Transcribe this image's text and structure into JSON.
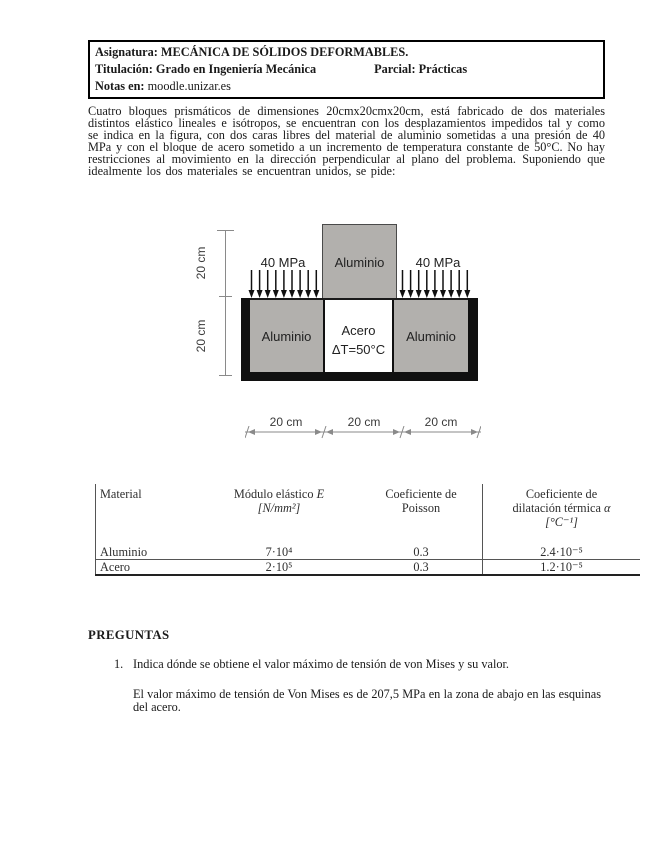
{
  "header_box": {
    "asignatura_label": "Asignatura:",
    "asignatura_value": " MECÁNICA DE SÓLIDOS DEFORMABLES.",
    "titulacion_label": "Titulación:",
    "titulacion_value": " Grado en Ingeniería Mecánica",
    "parcial_label": "Parcial:",
    "parcial_value": " Prácticas",
    "notas_label": "Notas en:",
    "notas_value": " moodle.unizar.es"
  },
  "problem_text": "Cuatro bloques prismáticos de dimensiones 20cmx20cmx20cm, está fabricado de dos materiales distintos elástico lineales e isótropos, se encuentran con los desplazamientos impedidos tal y como se indica en la figura, con dos caras libres del material de aluminio sometidas a una presión de 40 MPa y con el bloque de acero sometido a un incremento de temperatura constante de 50°C. No hay restricciones al movimiento en la dirección perpendicular al plano del problema. Suponiendo que idealmente los dos materiales se encuentran unidos, se pide:",
  "figure": {
    "dim_left_top": "20 cm",
    "dim_left_bottom": "20 cm",
    "pressure_left": "40 MPa",
    "pressure_right": "40 MPa",
    "top_block_label": "Aluminio",
    "bottom_left_label": "Aluminio",
    "center_label_line1": "Acero",
    "center_label_line2": "ΔT=50°C",
    "bottom_right_label": "Aluminio",
    "dim_bottom": [
      "20 cm",
      "20 cm",
      "20 cm"
    ],
    "colors": {
      "aluminium_fill": "#b2b0ad",
      "steel_fill": "#ffffff",
      "support_fill": "#101010"
    }
  },
  "table": {
    "header_material": "Material",
    "header_modulo": {
      "pre": "Módulo elástico ",
      "sym": "E",
      "unit": "[N/mm²]"
    },
    "header_poisson": "Coeficiente de\nPoisson",
    "header_dilatacion": {
      "pre": "Coeficiente de\ndilatación térmica ",
      "sym": "α",
      "unit": "[°C⁻¹]"
    },
    "rows": [
      [
        "Aluminio",
        "7·10⁴",
        "0.3",
        "2.4·10⁻⁵"
      ],
      [
        "Acero",
        "2·10⁵",
        "0.3",
        "1.2·10⁻⁵"
      ]
    ]
  },
  "questions": {
    "section_title": "PREGUNTAS",
    "q1_number": "1.",
    "q1_text": "Indica dónde se obtiene el valor máximo de tensión de von Mises y su valor.",
    "q1_answer": "El valor máximo de tensión de Von Mises es de 207,5 MPa en la zona de abajo en las esquinas del acero."
  }
}
